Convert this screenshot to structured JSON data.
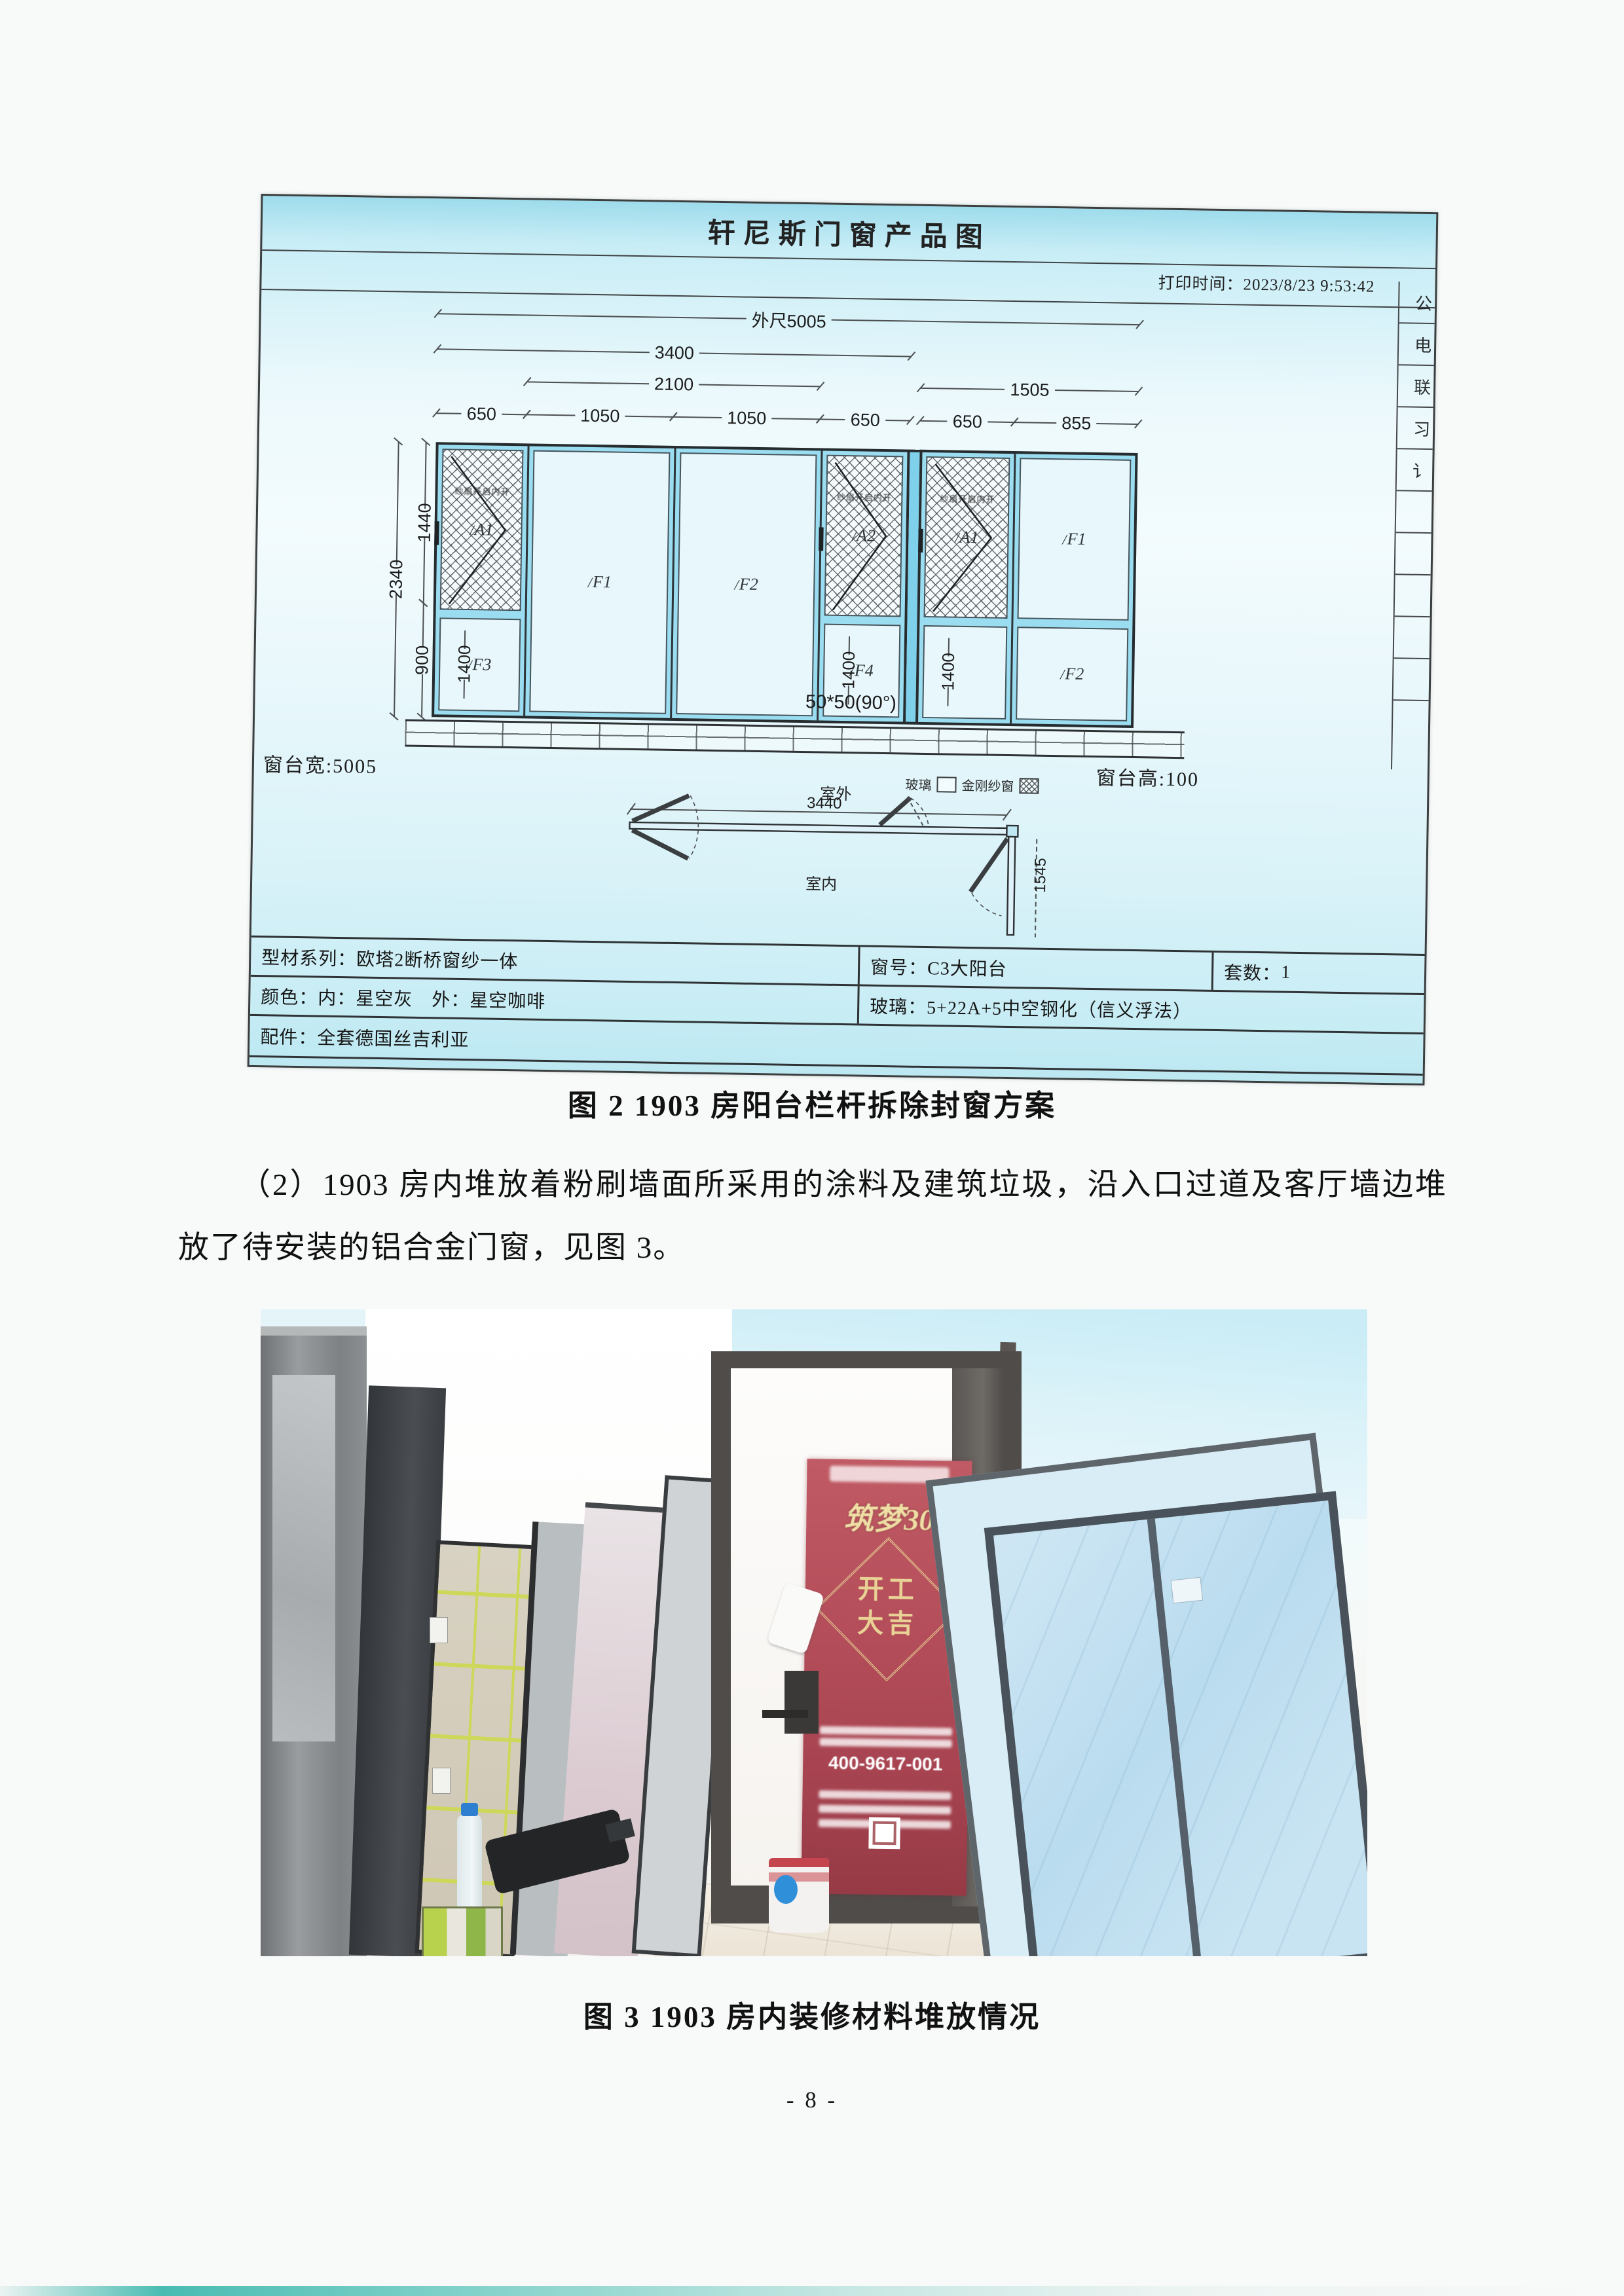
{
  "drawing": {
    "title": "轩尼斯门窗产品图",
    "print_time": "打印时间：2023/8/23 9:53:42",
    "side_labels": [
      "公",
      "电",
      "联",
      "习",
      "讠",
      "",
      "",
      "",
      "",
      ""
    ],
    "dims": {
      "outer": "外尺5005",
      "left_group": "3400",
      "mid_pair": "2100",
      "right_group": "1505",
      "segments": [
        "650",
        "1050",
        "1050",
        "650",
        "650",
        "855"
      ],
      "height_top": "1440",
      "height_total": "2340",
      "height_bottom": "900",
      "sash_height": "1400",
      "corner_note": "50*50(90°)",
      "sill_width": "窗台宽:5005",
      "sill_height": "窗台高:100"
    },
    "panels": {
      "a1": "A1",
      "a2": "A2",
      "f1": "F1",
      "f2": "F2",
      "f3": "F3",
      "f4": "F4",
      "mesh_note": "纱扇开启内开"
    },
    "plan": {
      "outside": "室外",
      "inside": "室内",
      "width": "3440",
      "leg": "1545",
      "legend_glass": "玻璃",
      "legend_mesh": "金刚纱窗"
    },
    "table": {
      "profile_label": "型材系列：",
      "profile_value": "欧塔2断桥窗纱一体",
      "window_no_label": "窗号：",
      "window_no_value": "C3大阳台",
      "sets_label": "套数：",
      "sets_value": "1",
      "color_label": "颜色：",
      "color_value": "内：星空灰　外：星空咖啡",
      "glass_label": "玻璃：",
      "glass_value": "5+22A+5中空钢化（信义浮法）",
      "parts_label": "配件：",
      "parts_value": "全套德国丝吉利亚"
    }
  },
  "captions": {
    "fig2": "图 2 1903 房阳台栏杆拆除封窗方案",
    "fig3": "图 3 1903 房内装修材料堆放情况"
  },
  "paragraph": "（2）1903 房内堆放着粉刷墙面所采用的涂料及建筑垃圾，沿入口过道及客厅墙边堆放了待安装的铝合金门窗，见图 3。",
  "photo": {
    "poster_title": "筑梦30",
    "poster_motto": "开工\n大吉",
    "poster_phone": "400-9617-001"
  },
  "page": {
    "number": "- 8 -"
  }
}
